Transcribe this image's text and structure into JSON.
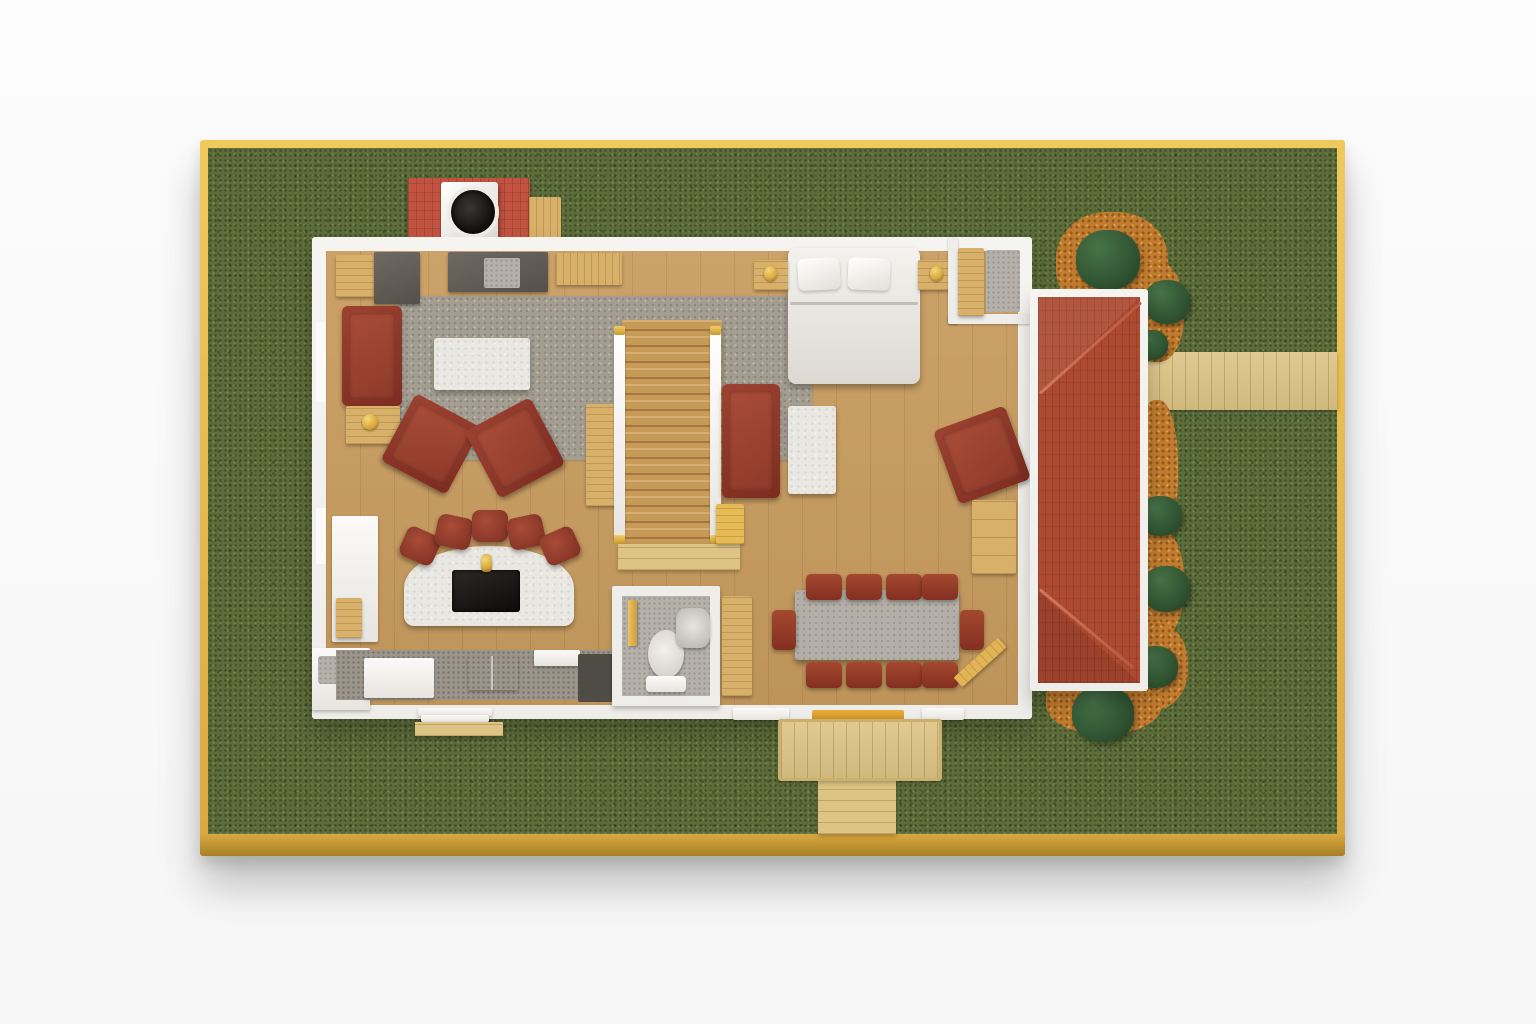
{
  "scene": {
    "kind": "photograph of an architectural scale model",
    "view": "top-down",
    "subject": "single-storey house cutaway model mounted on a grass board with a gold frame"
  },
  "palette": {
    "page_bg": "#fbfbfb",
    "frame_gold": "#d9a93f",
    "frame_gold_light": "#f0c95d",
    "frame_gold_dark": "#a87f26",
    "grass": "#5c6c3a",
    "walkway_wood": "#ddc485",
    "floor_wood": "#c89c5f",
    "wood_furniture": "#d8b06a",
    "wall_white": "#efede9",
    "roof_red": "#ae4a31",
    "brick_red": "#c25340",
    "flue_black": "#161412",
    "sofa_red": "#7e2c20",
    "sofa_red_light": "#9c4231",
    "rug_gray": "#a49e92",
    "marble": "#e9e7e2",
    "stone_gray": "#b5b1aa",
    "counter_gray": "#9b958b",
    "counter_dark": "#4f4b45",
    "table_gray": "#b3afa8",
    "mulch_orange": "#c07c2f",
    "bush_green": "#2f5231",
    "gold_accent": "#d9a93f"
  },
  "board": {
    "frame_material": "brushed gold",
    "ground_material": "model grass turf",
    "paths": [
      "side-walkway-east",
      "front-path-south",
      "back-deck"
    ]
  },
  "house": {
    "exterior": [
      "chimney-base",
      "chimney",
      "chimney-flue",
      "porch-red-hip-roof",
      "mulch-beds",
      "seven-round-shrubs",
      "entry-steps",
      "kitchen-step-pad"
    ],
    "living_room": [
      "red-sofa",
      "side-table-with-gold-lamp",
      "gray-area-rug",
      "white-marble-coffee-table",
      "red-armchair-left",
      "red-armchair-right",
      "stone-fireplace-hearth",
      "wood-media-console",
      "corner-wood-cabinet",
      "corner-dark-unit"
    ],
    "bar_lounge": [
      "curved-marble-bar",
      "black-screen-inset",
      "gold-trophy",
      "bar-stool-1",
      "bar-stool-2",
      "bar-stool-3",
      "bar-stool-4",
      "bar-stool-5"
    ],
    "kitchen": [
      "refrigerator-column",
      "corner-counter-with-sink",
      "counter-run",
      "dishwasher",
      "kitchen-sink",
      "dark-corner-counter"
    ],
    "hall": [
      "staircase",
      "left-railing",
      "right-railing",
      "stair-landing",
      "hall-console-table",
      "gold-step-box"
    ],
    "bathroom": [
      "toilet",
      "wall-sink",
      "wood-door",
      "linen-cabinet"
    ],
    "bedroom": [
      "double-bed",
      "pillow-left",
      "pillow-right",
      "nightstand-left",
      "nightstand-right",
      "lamp-left",
      "lamp-right",
      "closet-wardrobe",
      "closet-stone-mat"
    ],
    "study_corner": [
      "red-loveseat",
      "marble-side-table",
      "red-reading-armchair",
      "wood-dresser"
    ],
    "dining_room": [
      "gray-dining-table",
      "ten-red-dining-chairs",
      "open-wood-door"
    ]
  }
}
